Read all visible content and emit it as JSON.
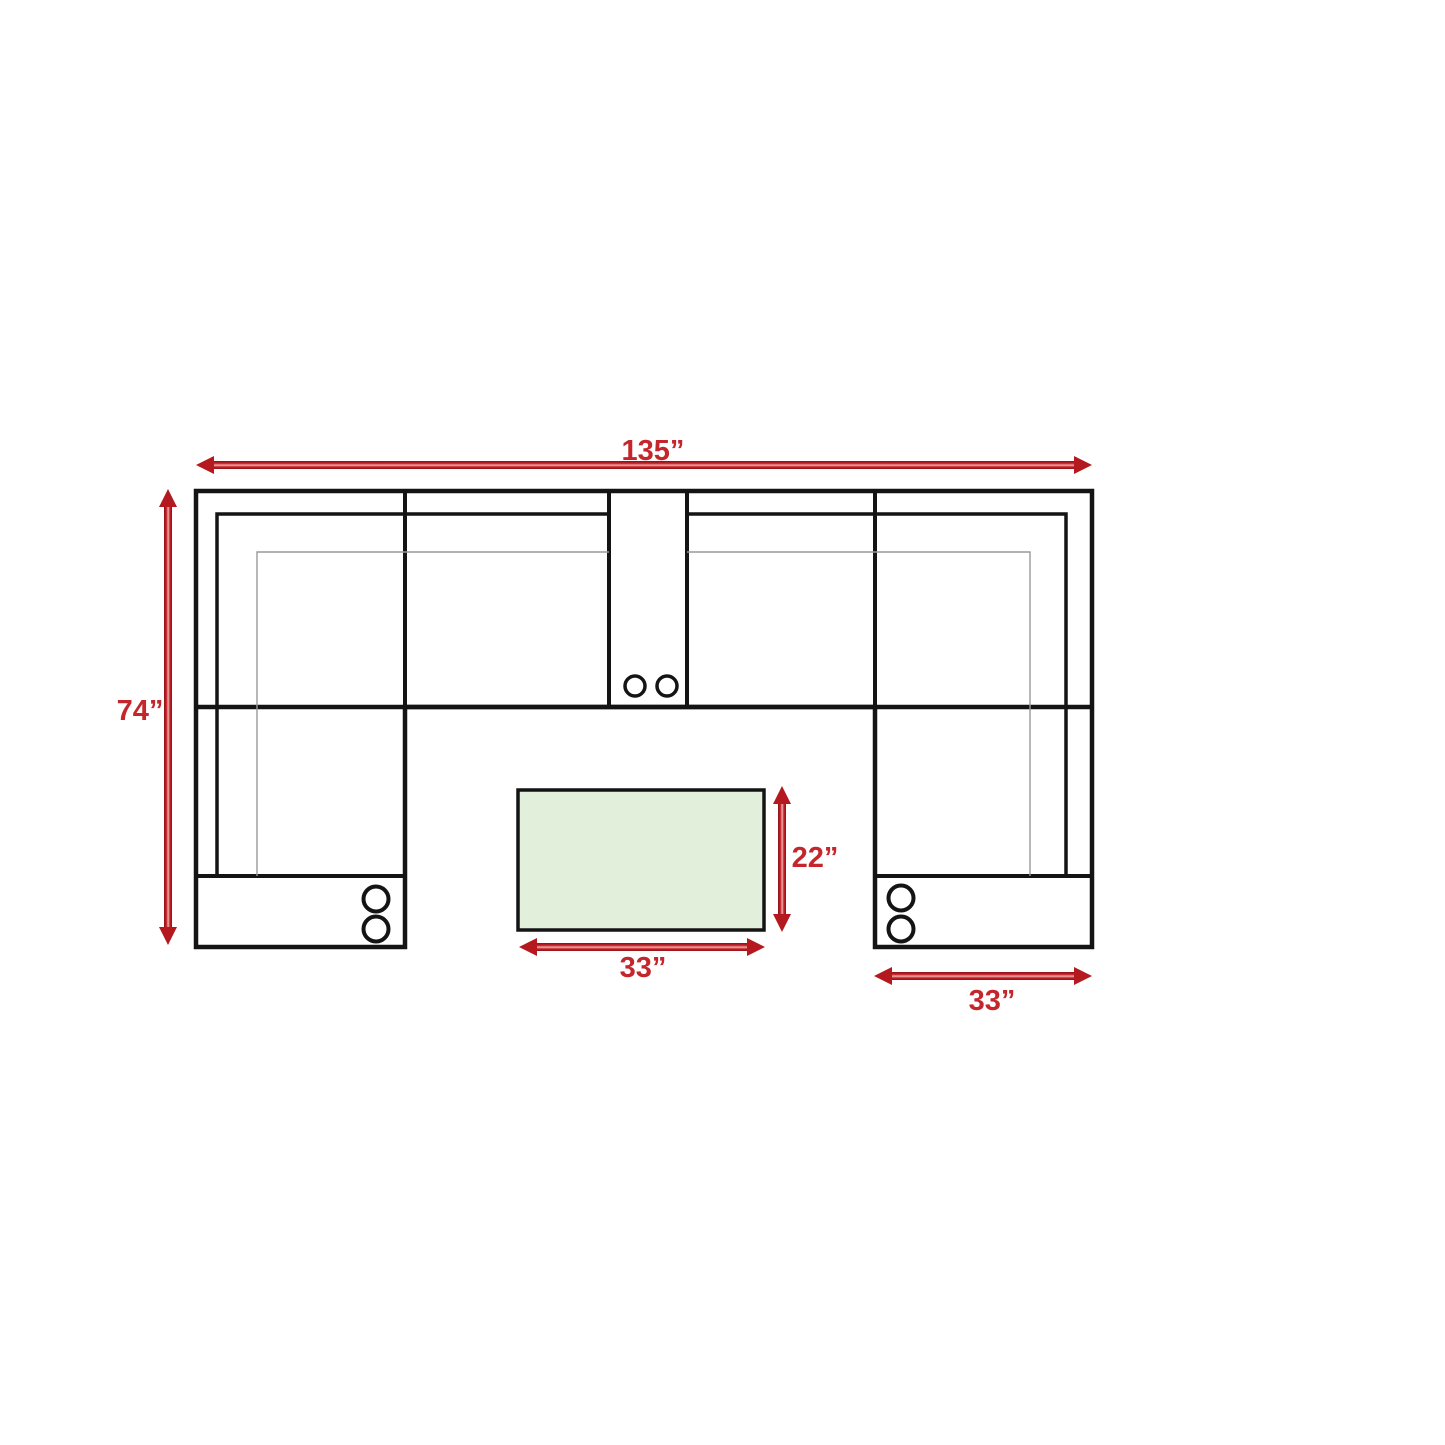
{
  "diagram": {
    "labels": {
      "overall_width": "135”",
      "overall_depth": "74”",
      "table_depth": "22”",
      "table_width": "33”",
      "chaise_width": "33”"
    },
    "colors": {
      "dimension_text": "#c5262c",
      "arrow_red": "#b3191e",
      "table_fill": "#e2efda",
      "outline_black": "#141414",
      "cushion_line_gray": "#999999"
    },
    "cupholders": {
      "console_count": 2,
      "left_chaise_count": 2,
      "right_chaise_count": 2
    }
  }
}
